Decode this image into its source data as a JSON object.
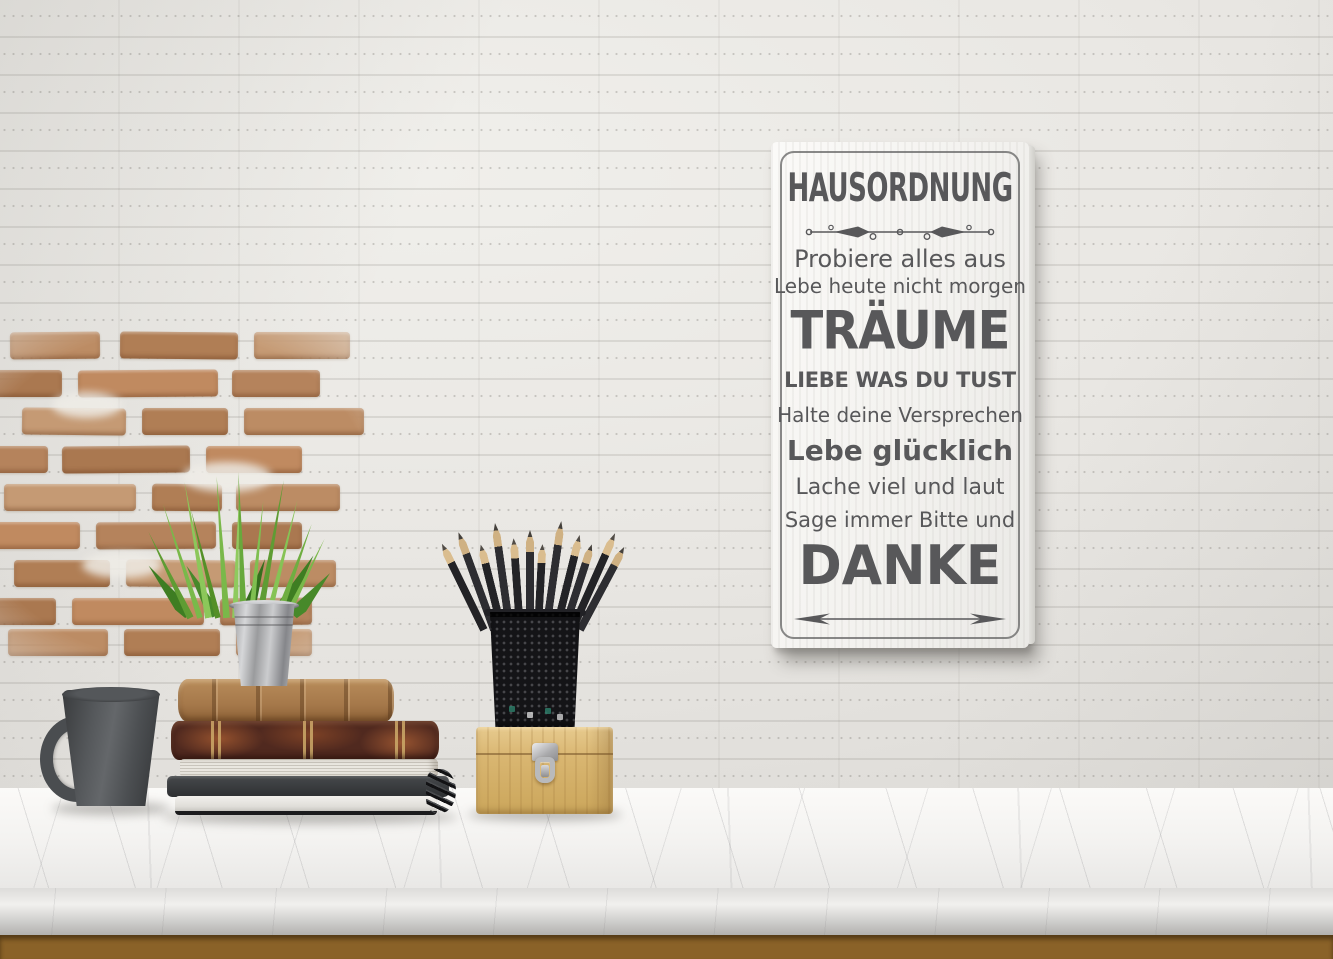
{
  "sign": {
    "title": "HAUSORDNUNG",
    "lines": [
      {
        "text": "Probiere alles aus",
        "style": "regular-large"
      },
      {
        "text": "Lebe heute nicht morgen",
        "style": "regular-medium"
      },
      {
        "text": "TRÄUME",
        "style": "huge-bold"
      },
      {
        "text": "LIEBE WAS DU TUST",
        "style": "caps-bold"
      },
      {
        "text": "Halte deine Versprechen",
        "style": "regular-medium"
      },
      {
        "text": "Lebe glücklich",
        "style": "bold-large"
      },
      {
        "text": "Lache viel und laut",
        "style": "regular-medium"
      },
      {
        "text": "Sage immer Bitte und",
        "style": "regular-medium"
      },
      {
        "text": "DANKE",
        "style": "huge-bold"
      }
    ],
    "text_color": "#58585A",
    "panel_color": "#F6F5F2"
  },
  "palette": {
    "wall_white": "#E9E7E3",
    "exposed_brick": "#B5835C",
    "marble_counter": "#F2F1EF",
    "marble_vein": "#8C8C8E",
    "wood_floor": "#96702F",
    "mug_charcoal": "#4B4E51",
    "book_tan": "#A87C4F",
    "book_maroon": "#50291F",
    "zinc_bucket": "#AEAFB1",
    "grass_green": "#76B53F",
    "pencil_black": "#242427",
    "pine_box": "#D5B06A",
    "latch_silver": "#B9B9BB"
  },
  "scene_objects": [
    "white painted brick wall",
    "exposed red brick patch",
    "wall canvas sign with house rules",
    "dark ceramic mug",
    "stack of old books with spiral notebook",
    "grass plant in zinc bucket",
    "black mesh pencil cup with pencils",
    "pine wood box with metal latch",
    "marble countertop",
    "wood floor strip"
  ]
}
